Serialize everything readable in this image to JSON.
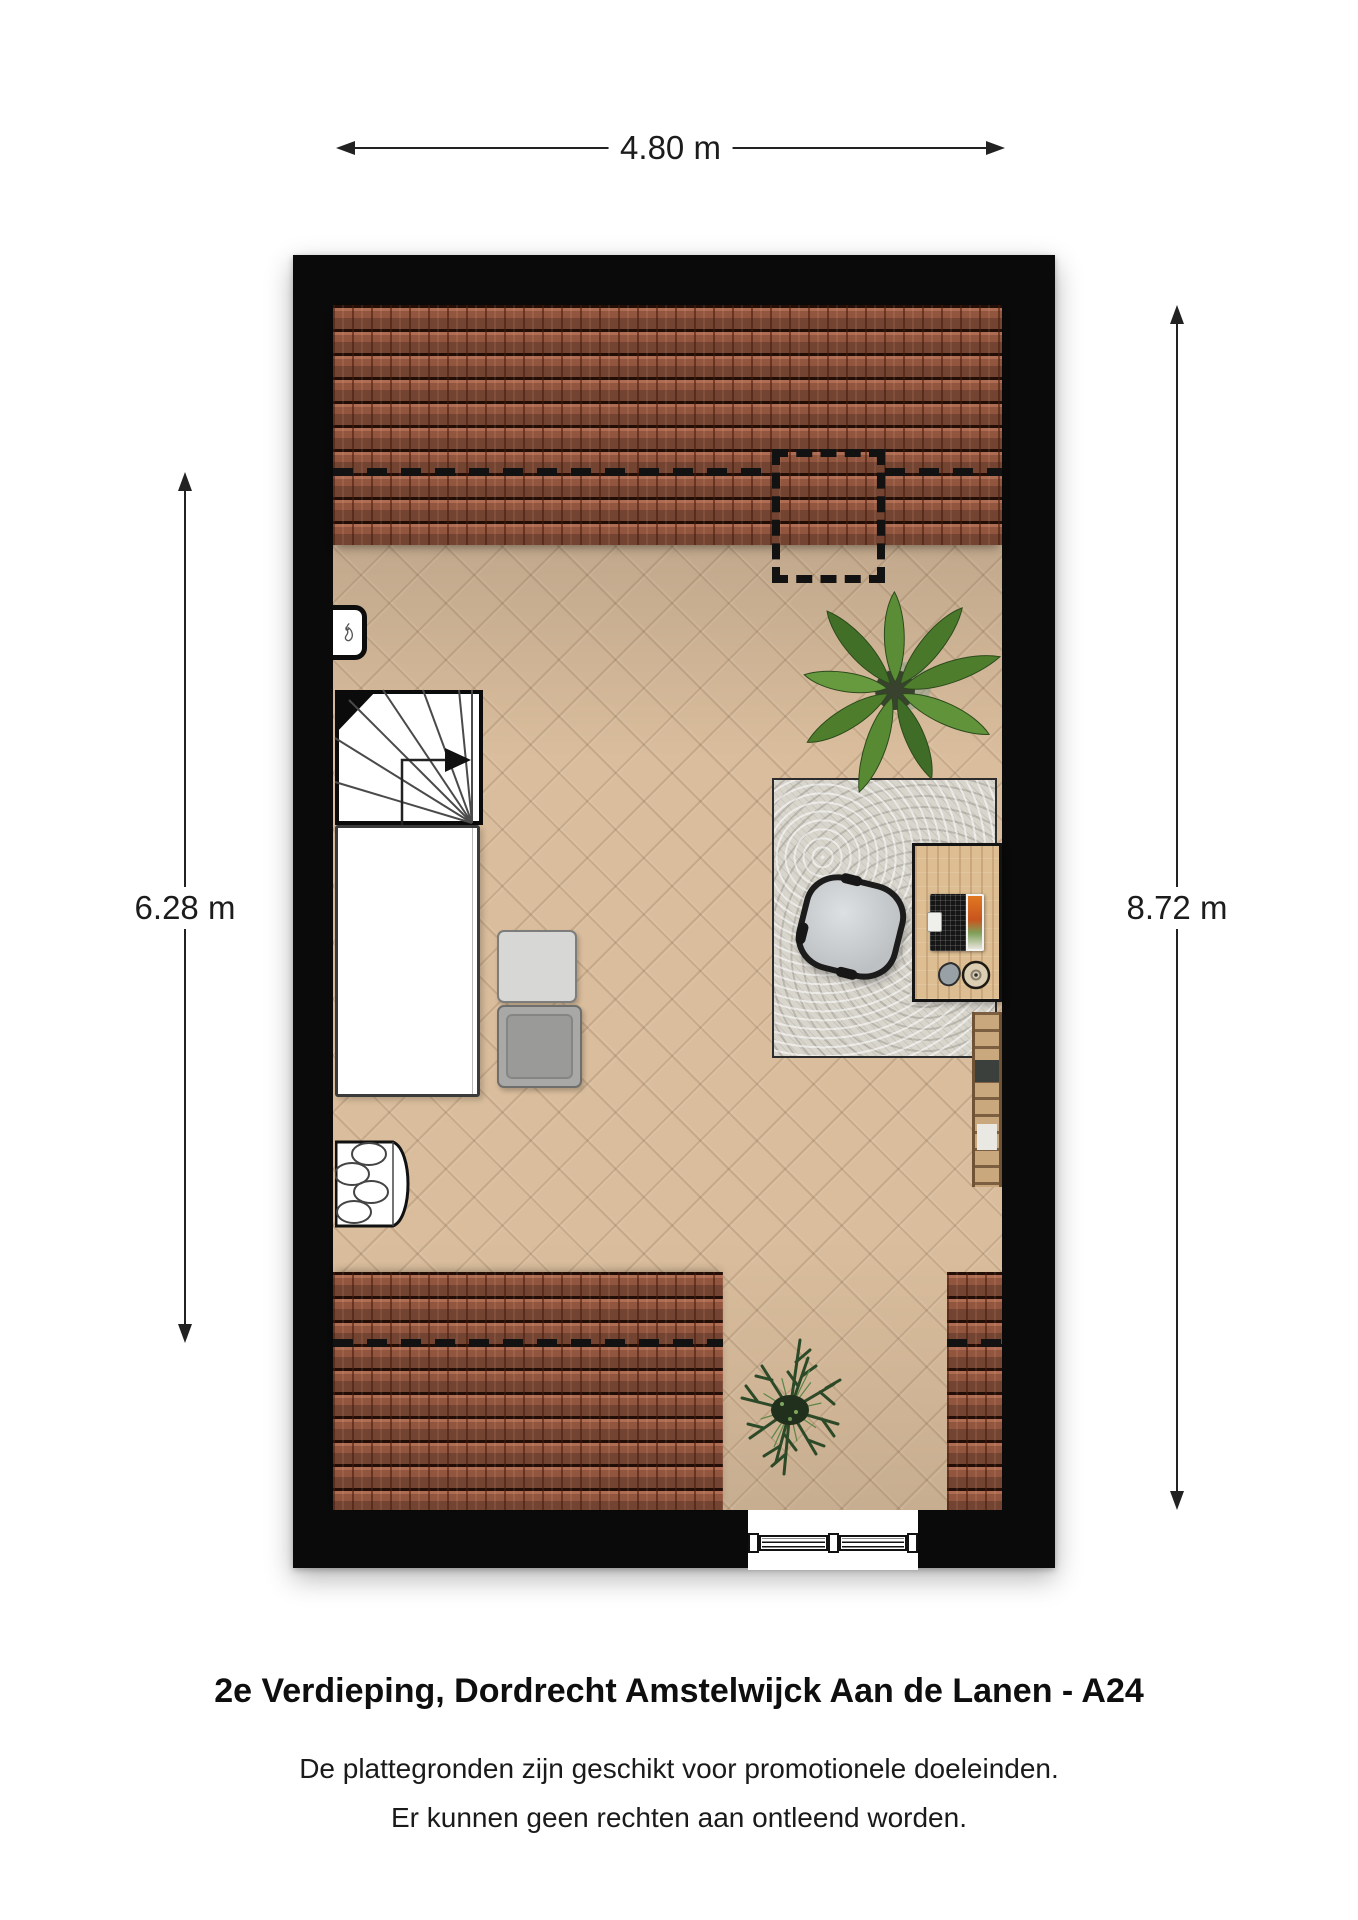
{
  "title": "2e Verdieping, Dordrecht Amstelwijck Aan de Lanen - A24",
  "disclaimer": {
    "line1": "De plattegronden zijn geschikt voor promotionele doeleinden.",
    "line2": "Er kunnen geen rechten aan ontleend worden."
  },
  "dimensions": {
    "top": {
      "label": "4.80 m"
    },
    "left": {
      "label": "6.28 m"
    },
    "right": {
      "label": "8.72 m"
    }
  },
  "colors": {
    "wall": "#0a0a0a",
    "roof_tile": "#9a5a42",
    "floor_wood": "#d9bd9c",
    "rug": "#d8d5cd",
    "desk_wood": "#ddbe93",
    "ladder_wood": "#c9a87d",
    "storage_box_light": "#d7d7d5",
    "storage_box_dark": "#a8a8a6",
    "plant_green": "#4d7c2b",
    "dimension_line": "#222222",
    "text": "#111111",
    "background": "#ffffff"
  },
  "icons": {
    "flame": "flame-icon",
    "palm_plant": "palm-plant-icon",
    "shrub_plant": "shrub-plant-icon",
    "stair_arrow": "stair-direction-arrow-icon",
    "window": "window-symbol"
  }
}
